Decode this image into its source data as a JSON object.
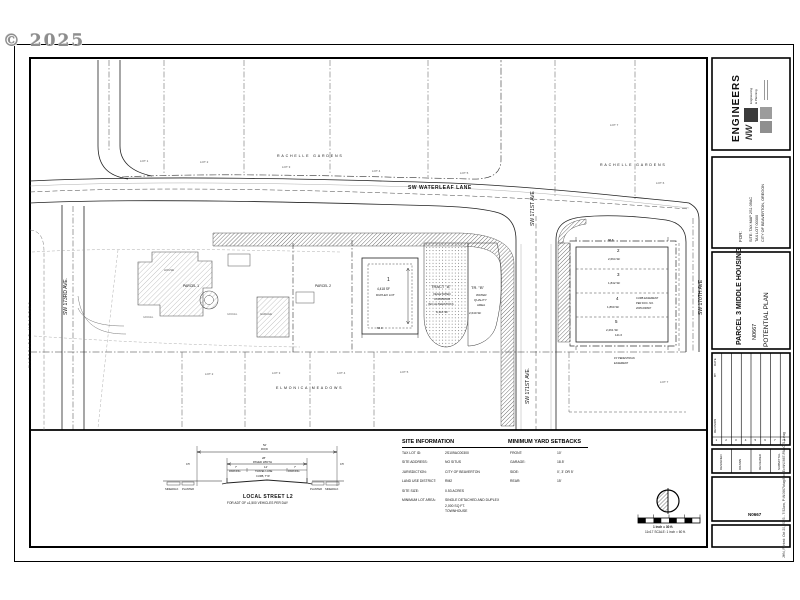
{
  "watermark": "© 2025",
  "plan": {
    "streets": {
      "waterleaf": "SW WATERLEAF LANE",
      "ave171_top": "SW 171ST AVE",
      "ave171_bottom": "SW 171ST AVE.",
      "ave173": "SW 173RD AVE.",
      "ave170": "SW 170TH AVE"
    },
    "subdivisions": {
      "rachelle_left": "RACHELLE GARDENS",
      "rachelle_right": "RACHELLE GARDENS",
      "waterleaf_meadows": "WATERLEAF MEADOWS",
      "elmonica": "ELMONICA MEADOWS"
    },
    "adjacent_lots": {
      "top": [
        "LOT 1",
        "LOT 2",
        "LOT 3",
        "LOT 4",
        "LOT 5"
      ],
      "right": [
        "LOT 7",
        "LOT 6"
      ],
      "bottom": [
        "LOT 2",
        "LOT 3",
        "LOT 4",
        "LOT 5"
      ],
      "east": "LOT 7"
    },
    "parcels": {
      "p1": "PARCEL 1",
      "p2": "PARCEL 2"
    },
    "existing": {
      "house": "HOUSE",
      "garage": "GARAGE",
      "gravel1": "GRAVEL",
      "gravel2": "GRAVEL"
    },
    "lot1": {
      "num": "1",
      "area": "4,418 SF",
      "note": "DUPLEX LOT"
    },
    "lot2": {
      "num": "2",
      "area": "2,664 SF"
    },
    "lot3": {
      "num": "3",
      "area": "1,842 SF"
    },
    "lot4": {
      "num": "4",
      "area": "1,860 SF"
    },
    "lot5": {
      "num": "5",
      "area": "2,261 SF"
    },
    "tract_a": {
      "name": "TRACT \"A\"",
      "l1": "VEGETATED",
      "l2": "CORRIDOR",
      "l3": "(NO ALTERATION)",
      "area": "9,110 SF"
    },
    "tract_b": {
      "name": "TR. \"B\"",
      "l1": "WATER",
      "l2": "QUALITY",
      "l3": "AREA",
      "area": "2,640 SF"
    },
    "notes": {
      "ped1": "15' PEDESTRIAN",
      "ped2": "EASEMENT",
      "curb1": "CURB EASEMENT",
      "curb2": "PER DOC. NO.",
      "curb3": "2005-090667"
    },
    "dims": {
      "d1": "88.8",
      "d2": "141.6",
      "d3": "84.0"
    }
  },
  "site_info": {
    "heading": "SITE INFORMATION",
    "rows": [
      {
        "label": "TAX LOT ID:",
        "value": "2S109AC00300"
      },
      {
        "label": "SITE ADDRESS:",
        "value": "NO SITUS"
      },
      {
        "label": "JURISDICTION:",
        "value": "CITY OF BEAVERTON"
      },
      {
        "label": "LAND USE DISTRICT:",
        "value": "RM2"
      },
      {
        "label": "SITE SIZE:",
        "value": "0.53 ACRES"
      },
      {
        "label": "MINIMUM LOT AREA:",
        "value": "SINGLE DETACHED AND DUPLEX"
      },
      {
        "label": "",
        "value": "2,000 SQ FT."
      },
      {
        "label": "",
        "value": "TOWNHOUSE"
      }
    ]
  },
  "setbacks": {
    "heading": "MINIMUM YARD SETBACKS",
    "rows": [
      {
        "label": "FRONT:",
        "value": "10'"
      },
      {
        "label": "GARAGE:",
        "value": "18.5'"
      },
      {
        "label": "SIDE:",
        "value": "0', 3' OR 5'"
      },
      {
        "label": "REAR:",
        "value": "15'"
      }
    ]
  },
  "section": {
    "title": "LOCAL STREET L2",
    "subtitle": "FOR ADT OF ≤1,500 VEHICLES PER DAY",
    "row_dim": "52'",
    "row_label": "ROW",
    "paved_dim": "28'",
    "paved_label": "PAVED WIDTH",
    "parking_dim": "7'",
    "parking_l": "PARKING",
    "travel_dim": "14'",
    "travel": "TRAVEL LANE",
    "parking_r": "PARKING",
    "curb": "CURB, TYP.",
    "sw_l": "SIDEWALK",
    "pl_l": "PLANTER",
    "pl_r": "PLANTER",
    "sw_r": "SIDEWALK",
    "half": "0.5'"
  },
  "scalebar": {
    "line1": "1 inch = 30 ft.",
    "line2": "11x17 SCALE: 1 inch = 60 ft."
  },
  "titleblock": {
    "brand": {
      "nw": "NW",
      "name": "ENGINEERS",
      "tag1": "Engineering",
      "tag2": "& Planning"
    },
    "for_label": "FOR:",
    "for_line1": "SITE: TAX MAP 2S1 09AC",
    "for_line2": "TAX LOT 00300",
    "for_line3": "CITY OF BEAVERTON, OREGON",
    "project_title": "PARCEL 3 MIDDLE HOUSING",
    "project_number": "N0667",
    "sheet_title": "POTENTIAL PLAN",
    "rev_date": "DATE",
    "rev_by": "BY",
    "rev_desc": "REVISION",
    "rev_numbers": [
      "1",
      "2",
      "3",
      "4",
      "5",
      "6",
      "7",
      "8"
    ],
    "signoff": [
      "DESIGNED",
      "DRAWN",
      "REVIEWED",
      "SUBMITTAL"
    ],
    "job_number": "N0667",
    "plot_stamp": "JHN, Printed: Oct 20, 2023 - 7:52am,  P:\\N0667\\dwg\\Plot\\Exh\\N0667-PARCEL3.dwg"
  }
}
